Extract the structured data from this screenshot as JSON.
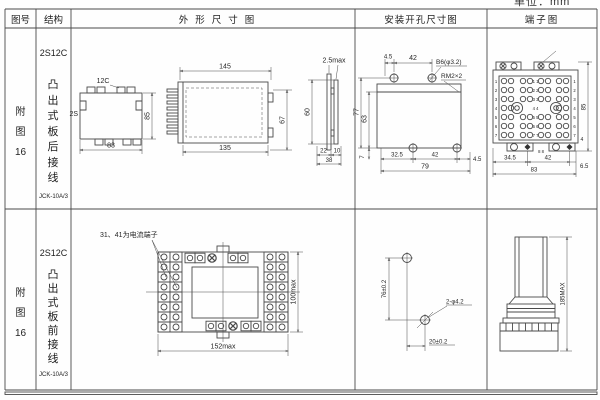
{
  "unit_label": "单位：mm",
  "header": {
    "fig_no": "图号",
    "structure": "结构",
    "outline": "外形尺寸图",
    "mounting": "安装开孔尺寸图",
    "terminal": "端子图"
  },
  "rows": [
    {
      "fig_lines": [
        "附",
        "图",
        "16"
      ],
      "model": "2S12C",
      "structure_text": "凸出式板后接线",
      "product_code": "JCK-10A/3",
      "outline": {
        "front_top_label": "12C",
        "front_left_label": "2S",
        "front_width": "83",
        "front_height": "85",
        "side_top": "145",
        "side_bottom": "135",
        "side_height": "67",
        "panel_gap": "2.5max",
        "panel_height": "60",
        "panel_b1": "22",
        "panel_b2": "10",
        "panel_b3": "38"
      },
      "mounting": {
        "top_d1": "4.5",
        "top_d2": "42",
        "hole_spec": "B6(φ3.2)",
        "thread_spec": "RM2×2",
        "left_d1": "77",
        "left_d2": "63",
        "left_d3": "7",
        "bottom_d1": "32.5",
        "bottom_d2": "42",
        "bottom_d3": "4.5",
        "bottom_total": "79"
      },
      "terminal": {
        "bottom_d1": "34.5",
        "bottom_d2": "42",
        "bottom_d3": "6.5",
        "bottom_total": "83",
        "right_height": "85",
        "foot_d": "4",
        "rows_left": [
          "1",
          "2",
          "3",
          "4",
          "5",
          "6",
          "7"
        ],
        "rows_right": [
          "1",
          "2",
          "3",
          "4",
          "5",
          "6",
          "7"
        ],
        "center": [
          "1 1",
          "2 2",
          "3 3",
          "4 4",
          "5 5",
          "6 6",
          "7 7"
        ],
        "bottom_pair": "8 8"
      }
    },
    {
      "fig_lines": [
        "附",
        "图",
        "16"
      ],
      "model": "2S12C",
      "structure_text": "凸出式板前接线",
      "product_code": "JCK-10A/3",
      "outline": {
        "note": "31、41为电流端子",
        "width": "152max",
        "height": "100max"
      },
      "mounting": {
        "vertical": "76±0.2",
        "horizontal": "20±0.2",
        "hole_spec": "2-φ4.2"
      },
      "terminal": {
        "height": "185MAX"
      }
    }
  ]
}
